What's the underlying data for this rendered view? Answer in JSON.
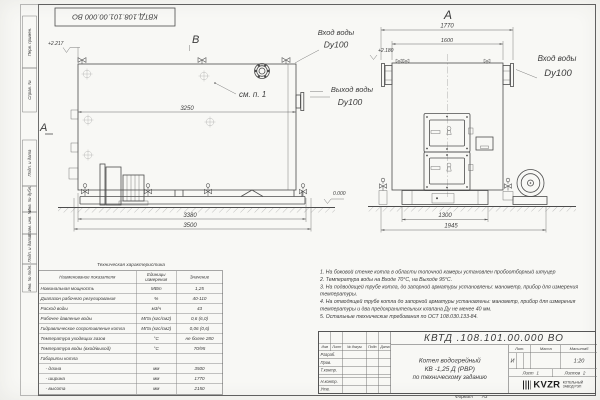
{
  "frame": {
    "code_mirrored": "КВТД.108.101.00.000 ВО",
    "margin_labels": [
      "Перв. примен.",
      "Справ. №",
      "Подп. и дата",
      "Инв. № дубл.",
      "Взам. инв. №",
      "Подп. и дата",
      "Инв. № подл."
    ],
    "format_label": "Формат",
    "format_value": "А3"
  },
  "views": {
    "side": {
      "view_label": "В",
      "section_label": "А",
      "elevation": "+2.217",
      "callout": "см. п. 1",
      "dim_top": "3250",
      "dim_frame": "3380",
      "dim_overall": "3500"
    },
    "front": {
      "view_label": "А",
      "dim_overall_width": "1770",
      "dim_flange_span": "1600",
      "dim_base": "1300",
      "dim_with_fan": "1945",
      "elevation_zero": "0.000",
      "elevation_pipe": "+2.180"
    },
    "pipe_labels": {
      "inlet_side": "Вход воды",
      "inlet_side_dn": "Dy100",
      "outlet": "Выход воды",
      "outlet_dn": "Dy100",
      "inlet_front": "Вход воды",
      "inlet_front_dn": "Dy100"
    }
  },
  "tech_table": {
    "title": "Техническая характеристика",
    "headers": [
      "Наименование показателя",
      "Единицы измерения",
      "Значение"
    ],
    "rows": [
      [
        "Номинальная мощность",
        "МВт",
        "1,25"
      ],
      [
        "Диапазон рабочего регулирования",
        "%",
        "40-110"
      ],
      [
        "Расход воды",
        "м3/ч",
        "43"
      ],
      [
        "Рабочее давление воды",
        "МПа (кгс/см2)",
        "0,6 (6,0)"
      ],
      [
        "Гидравлическое сопротивление котла",
        "МПа (кгс/см2)",
        "0,06 (0,6)"
      ],
      [
        "Температура уходящих газов",
        "°С",
        "не более 280"
      ],
      [
        "Температура воды (вход/выход)",
        "°С",
        "70/95"
      ],
      [
        "Габариты котла",
        "",
        ""
      ],
      [
        "    - длина",
        "мм",
        "3500"
      ],
      [
        "    - ширина",
        "мм",
        "1770"
      ],
      [
        "    - высота",
        "мм",
        "2150"
      ]
    ]
  },
  "notes": [
    "1.  На боковой стенке котла в области топочной камеры установлен пробоотборный штуцер",
    "2.  Температура воды на Входе 70°С, на Выходе 95°С.",
    "3.  На подводящей трубе котла, до запорной арматуры установлены: манометр, прибор для измерения температуры.",
    "4.  На отводящей трубе котла до запорной арматуры установлены: манометр, прибор для измерения температуры и два предохранительных клапана Ду не менее 40 мм.",
    "5.  Остальные технические требования по ОСТ 108.030.133-84."
  ],
  "title_block": {
    "code": "КВТД .108.101.00.000  ВО",
    "product_line1": "Котел водогрейный",
    "product_line2": "КВ -1,25  Д  (РВР)",
    "product_line3": "по техническому заданию",
    "col_headers": [
      "Изм",
      "Лист",
      "№ докум.",
      "Подп.",
      "Дата"
    ],
    "row_labels": [
      "Разраб.",
      "Пров.",
      "Т.контр.",
      "",
      "Н.контр.",
      "Утв."
    ],
    "lit_label": "Лит.",
    "mass_label": "Масса",
    "scale_label": "Масштаб",
    "lit_value": "И",
    "scale_value": "1:20",
    "sheet_label": "Лист",
    "sheet_value": "1",
    "sheets_label": "Листов",
    "sheets_value": "2",
    "logo_text": "KVZR",
    "logo_line1": "КОТЕЛЬНЫЙ",
    "logo_line2": "ЗАВОД РЭП"
  }
}
